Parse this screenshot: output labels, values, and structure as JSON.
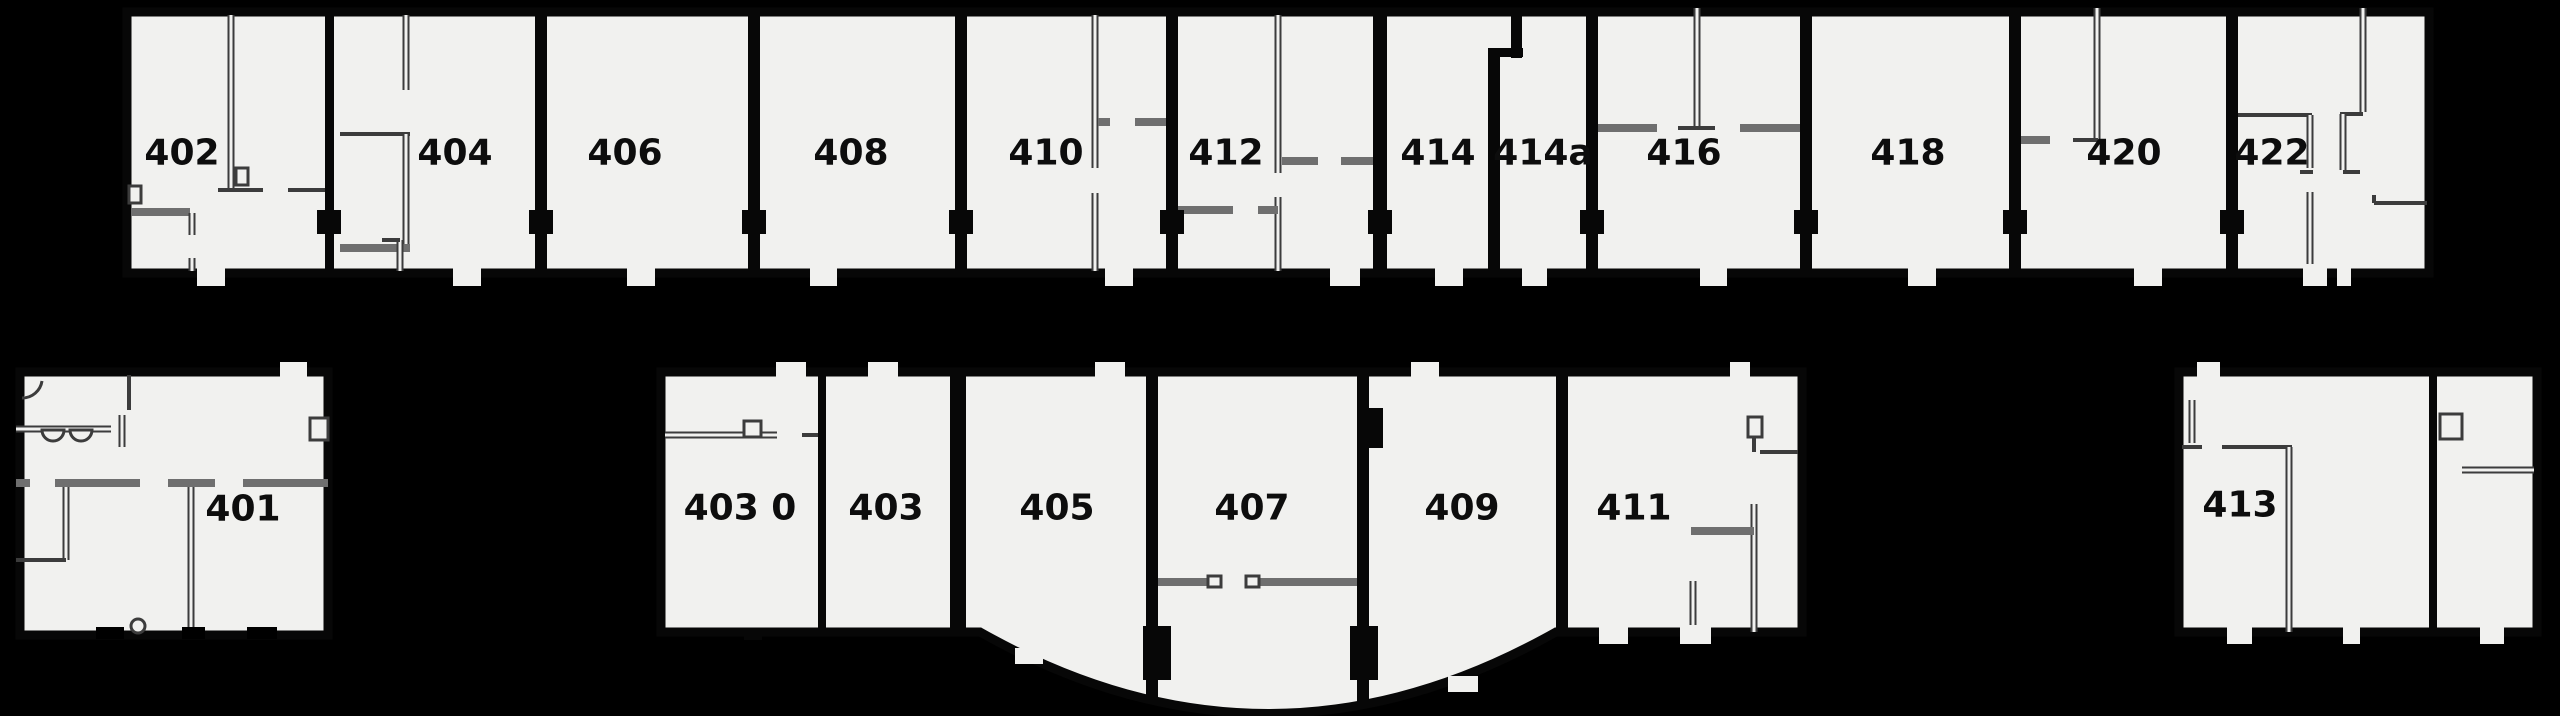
{
  "plan": {
    "title": "floor-plan-level-4",
    "colors": {
      "background": "#000000",
      "room_fill": "#f1f1ef",
      "outer_wall": "#070707",
      "inner_wall_dark": "#3c3c3c",
      "inner_wall_gray": "#6f6f6f",
      "inner_wall_core": "#f1f1ef",
      "label": "#0d0d0d"
    },
    "label_font_size": 36,
    "rooms_top_row": [
      "402",
      "404",
      "406",
      "408",
      "410",
      "412",
      "414",
      "414a",
      "416",
      "418",
      "420",
      "422"
    ],
    "rooms_bottom_row": [
      "401",
      "403 0",
      "403",
      "405",
      "407",
      "409",
      "411",
      "413"
    ],
    "blocks": [
      {
        "name": "top-row-block",
        "path": "M127,12 H2429 V273 H127 Z"
      },
      {
        "name": "room-401-block",
        "path": "M20,372 H328 V635 H20 Z"
      },
      {
        "name": "middle-bottom-block",
        "path": "M661,372 H1802 V632 H1556 Q1268,795 980,632 H661 Z"
      },
      {
        "name": "room-413-block",
        "path": "M2179,372 H2537 V632 H2179 Z"
      }
    ],
    "separators": [
      [
        325,
        15,
        9,
        256
      ],
      [
        535,
        15,
        12,
        256
      ],
      [
        748,
        15,
        12,
        256
      ],
      [
        955,
        15,
        12,
        256
      ],
      [
        1166,
        15,
        12,
        256
      ],
      [
        1373,
        15,
        14,
        256
      ],
      [
        1488,
        55,
        12,
        216
      ],
      [
        1511,
        8,
        11,
        50
      ],
      [
        1488,
        48,
        35,
        9
      ],
      [
        1586,
        15,
        12,
        256
      ],
      [
        1800,
        15,
        12,
        256
      ],
      [
        2009,
        15,
        12,
        256
      ],
      [
        2226,
        15,
        12,
        256
      ],
      [
        818,
        375,
        8,
        257
      ],
      [
        950,
        375,
        16,
        257
      ],
      [
        1146,
        375,
        12,
        325
      ],
      [
        1357,
        375,
        12,
        330
      ],
      [
        1556,
        375,
        12,
        257
      ],
      [
        2429,
        375,
        8,
        257
      ]
    ],
    "door_blocks": [
      [
        317,
        210,
        24,
        24
      ],
      [
        529,
        210,
        24,
        24
      ],
      [
        742,
        210,
        24,
        24
      ],
      [
        949,
        210,
        24,
        24
      ],
      [
        1160,
        210,
        24,
        24
      ],
      [
        1368,
        210,
        24,
        24
      ],
      [
        1580,
        210,
        24,
        24
      ],
      [
        1794,
        210,
        24,
        24
      ],
      [
        2003,
        210,
        24,
        24
      ],
      [
        2220,
        210,
        24,
        24
      ],
      [
        1143,
        626,
        28,
        54
      ],
      [
        1350,
        626,
        28,
        54
      ],
      [
        1357,
        408,
        26,
        40
      ],
      [
        744,
        628,
        18,
        12
      ]
    ],
    "white_tabs": [
      [
        197,
        264,
        28,
        22
      ],
      [
        453,
        264,
        28,
        22
      ],
      [
        627,
        264,
        28,
        22
      ],
      [
        810,
        264,
        27,
        22
      ],
      [
        1105,
        264,
        28,
        22
      ],
      [
        1330,
        264,
        30,
        22
      ],
      [
        1435,
        264,
        28,
        22
      ],
      [
        1522,
        264,
        25,
        22
      ],
      [
        1700,
        264,
        27,
        22
      ],
      [
        1908,
        264,
        28,
        22
      ],
      [
        2134,
        264,
        28,
        22
      ],
      [
        2303,
        264,
        24,
        22
      ],
      [
        2337,
        264,
        14,
        22
      ],
      [
        280,
        362,
        27,
        18
      ],
      [
        776,
        362,
        30,
        18
      ],
      [
        868,
        362,
        30,
        18
      ],
      [
        1095,
        362,
        30,
        18
      ],
      [
        1411,
        362,
        28,
        18
      ],
      [
        1730,
        362,
        20,
        18
      ],
      [
        2197,
        362,
        23,
        18
      ],
      [
        1599,
        625,
        29,
        19
      ],
      [
        1680,
        625,
        31,
        19
      ],
      [
        2227,
        625,
        25,
        19
      ],
      [
        2343,
        625,
        17,
        19
      ],
      [
        2480,
        625,
        24,
        19
      ],
      [
        1015,
        648,
        28,
        16
      ],
      [
        1448,
        676,
        30,
        16
      ]
    ],
    "black_gaps": [
      [
        96,
        627,
        28,
        12
      ],
      [
        182,
        627,
        23,
        12
      ],
      [
        247,
        627,
        30,
        12
      ]
    ],
    "inner_walls": [
      {
        "s": [
          231,
          15,
          231,
          188
        ],
        "t": "d"
      },
      {
        "s": [
          218,
          190,
          263,
          190
        ],
        "t": "t"
      },
      {
        "s": [
          288,
          190,
          325,
          190
        ],
        "t": "t"
      },
      {
        "s": [
          131,
          212,
          190,
          212
        ],
        "t": "g"
      },
      {
        "s": [
          192,
          213,
          192,
          235
        ],
        "t": "d"
      },
      {
        "s": [
          192,
          258,
          192,
          271
        ],
        "t": "d"
      },
      {
        "s": [
          406,
          15,
          406,
          90
        ],
        "t": "d"
      },
      {
        "s": [
          340,
          134,
          410,
          134
        ],
        "t": "t"
      },
      {
        "s": [
          406,
          134,
          406,
          248
        ],
        "t": "d"
      },
      {
        "s": [
          340,
          248,
          410,
          248
        ],
        "t": "g"
      },
      {
        "s": [
          400,
          240,
          400,
          271
        ],
        "t": "d"
      },
      {
        "s": [
          382,
          240,
          400,
          240
        ],
        "t": "t"
      },
      {
        "s": [
          1095,
          15,
          1095,
          168
        ],
        "t": "d"
      },
      {
        "s": [
          1098,
          122,
          1110,
          122
        ],
        "t": "g"
      },
      {
        "s": [
          1135,
          122,
          1166,
          122
        ],
        "t": "g"
      },
      {
        "s": [
          1095,
          193,
          1095,
          271
        ],
        "t": "d"
      },
      {
        "s": [
          1278,
          15,
          1278,
          173
        ],
        "t": "d"
      },
      {
        "s": [
          1282,
          161,
          1318,
          161
        ],
        "t": "g"
      },
      {
        "s": [
          1341,
          161,
          1373,
          161
        ],
        "t": "g"
      },
      {
        "s": [
          1178,
          210,
          1233,
          210
        ],
        "t": "g"
      },
      {
        "s": [
          1278,
          197,
          1278,
          271
        ],
        "t": "d"
      },
      {
        "s": [
          1258,
          210,
          1278,
          210
        ],
        "t": "g"
      },
      {
        "s": [
          1697,
          8,
          1697,
          127
        ],
        "t": "d"
      },
      {
        "s": [
          1598,
          128,
          1657,
          128
        ],
        "t": "g"
      },
      {
        "s": [
          1678,
          128,
          1715,
          128
        ],
        "t": "t"
      },
      {
        "s": [
          1740,
          128,
          1800,
          128
        ],
        "t": "g"
      },
      {
        "s": [
          2021,
          140,
          2050,
          140
        ],
        "t": "g"
      },
      {
        "s": [
          2097,
          8,
          2097,
          140
        ],
        "t": "d"
      },
      {
        "s": [
          2073,
          140,
          2098,
          140
        ],
        "t": "t"
      },
      {
        "s": [
          2238,
          115,
          2312,
          115
        ],
        "t": "t"
      },
      {
        "s": [
          2310,
          115,
          2310,
          168
        ],
        "t": "d"
      },
      {
        "s": [
          2300,
          172,
          2313,
          172
        ],
        "t": "t"
      },
      {
        "s": [
          2310,
          192,
          2310,
          271
        ],
        "t": "d"
      },
      {
        "s": [
          2363,
          8,
          2363,
          112
        ],
        "t": "d"
      },
      {
        "s": [
          2340,
          114,
          2363,
          114
        ],
        "t": "t"
      },
      {
        "s": [
          2343,
          114,
          2343,
          170
        ],
        "t": "d"
      },
      {
        "s": [
          2343,
          172,
          2360,
          172
        ],
        "t": "t"
      },
      {
        "s": [
          2374,
          203,
          2427,
          203
        ],
        "t": "t"
      },
      {
        "s": [
          2374,
          195,
          2374,
          203
        ],
        "t": "t"
      },
      {
        "s": [
          16,
          429,
          111,
          429
        ],
        "t": "d"
      },
      {
        "s": [
          122,
          415,
          122,
          447
        ],
        "t": "d"
      },
      {
        "s": [
          129,
          375,
          129,
          410
        ],
        "t": "t"
      },
      {
        "s": [
          16,
          483,
          30,
          483
        ],
        "t": "g"
      },
      {
        "s": [
          55,
          483,
          140,
          483
        ],
        "t": "g"
      },
      {
        "s": [
          168,
          483,
          215,
          483
        ],
        "t": "g"
      },
      {
        "s": [
          243,
          483,
          328,
          483
        ],
        "t": "g"
      },
      {
        "s": [
          66,
          487,
          66,
          560
        ],
        "t": "d"
      },
      {
        "s": [
          16,
          560,
          66,
          560
        ],
        "t": "t"
      },
      {
        "s": [
          191,
          487,
          191,
          632
        ],
        "t": "d"
      },
      {
        "s": [
          665,
          435,
          777,
          435
        ],
        "t": "d"
      },
      {
        "s": [
          802,
          435,
          818,
          435
        ],
        "t": "t"
      },
      {
        "s": [
          1152,
          582,
          1214,
          582
        ],
        "t": "g"
      },
      {
        "s": [
          1252,
          582,
          1357,
          582
        ],
        "t": "g"
      },
      {
        "s": [
          1760,
          452,
          1798,
          452
        ],
        "t": "t"
      },
      {
        "s": [
          1754,
          424,
          1754,
          452
        ],
        "t": "t"
      },
      {
        "s": [
          1754,
          504,
          1754,
          632
        ],
        "t": "d"
      },
      {
        "s": [
          1691,
          531,
          1754,
          531
        ],
        "t": "g"
      },
      {
        "s": [
          1693,
          581,
          1693,
          632
        ],
        "t": "d"
      },
      {
        "s": [
          2182,
          447,
          2202,
          447
        ],
        "t": "t"
      },
      {
        "s": [
          2222,
          447,
          2292,
          447
        ],
        "t": "t"
      },
      {
        "s": [
          2289,
          447,
          2289,
          632
        ],
        "t": "d"
      },
      {
        "s": [
          2192,
          400,
          2192,
          443
        ],
        "t": "d"
      },
      {
        "s": [
          2462,
          470,
          2534,
          470
        ],
        "t": "d"
      }
    ],
    "fixtures": [
      {
        "type": "rect",
        "d": [
          236,
          168,
          12,
          17
        ]
      },
      {
        "type": "rect",
        "d": [
          129,
          186,
          12,
          17
        ]
      },
      {
        "type": "rect",
        "d": [
          744,
          421,
          17,
          16
        ]
      },
      {
        "type": "rect",
        "d": [
          1208,
          576,
          13,
          11
        ]
      },
      {
        "type": "rect",
        "d": [
          1246,
          576,
          13,
          11
        ]
      },
      {
        "type": "rect",
        "d": [
          1748,
          417,
          14,
          20
        ]
      },
      {
        "type": "rect",
        "d": [
          310,
          418,
          18,
          22
        ]
      },
      {
        "type": "rect",
        "d": [
          2440,
          414,
          22,
          25
        ]
      },
      {
        "type": "circle",
        "d": [
          138,
          626,
          7
        ]
      },
      {
        "type": "path",
        "d": "M42,430 A11,11 0 0 0 64,430 Z"
      },
      {
        "type": "path",
        "d": "M70,430 A11,11 0 0 0 92,430 Z"
      },
      {
        "type": "path",
        "d": "M22,398 A20,20 0 0 0 42,381"
      }
    ],
    "labels": [
      {
        "text": "402",
        "x": 182,
        "y": 153
      },
      {
        "text": "404",
        "x": 455,
        "y": 153
      },
      {
        "text": "406",
        "x": 625,
        "y": 153
      },
      {
        "text": "408",
        "x": 851,
        "y": 153
      },
      {
        "text": "410",
        "x": 1046,
        "y": 153
      },
      {
        "text": "412",
        "x": 1226,
        "y": 153
      },
      {
        "text": "414",
        "x": 1438,
        "y": 153
      },
      {
        "text": "414a",
        "x": 1543,
        "y": 153
      },
      {
        "text": "416",
        "x": 1684,
        "y": 153
      },
      {
        "text": "418",
        "x": 1908,
        "y": 153
      },
      {
        "text": "420",
        "x": 2124,
        "y": 153
      },
      {
        "text": "422",
        "x": 2272,
        "y": 153
      },
      {
        "text": "401",
        "x": 243,
        "y": 509
      },
      {
        "text": "403 0",
        "x": 740,
        "y": 508
      },
      {
        "text": "403",
        "x": 886,
        "y": 508
      },
      {
        "text": "405",
        "x": 1057,
        "y": 508
      },
      {
        "text": "407",
        "x": 1252,
        "y": 508
      },
      {
        "text": "409",
        "x": 1462,
        "y": 508
      },
      {
        "text": "411",
        "x": 1634,
        "y": 508
      },
      {
        "text": "413",
        "x": 2240,
        "y": 505
      }
    ]
  }
}
